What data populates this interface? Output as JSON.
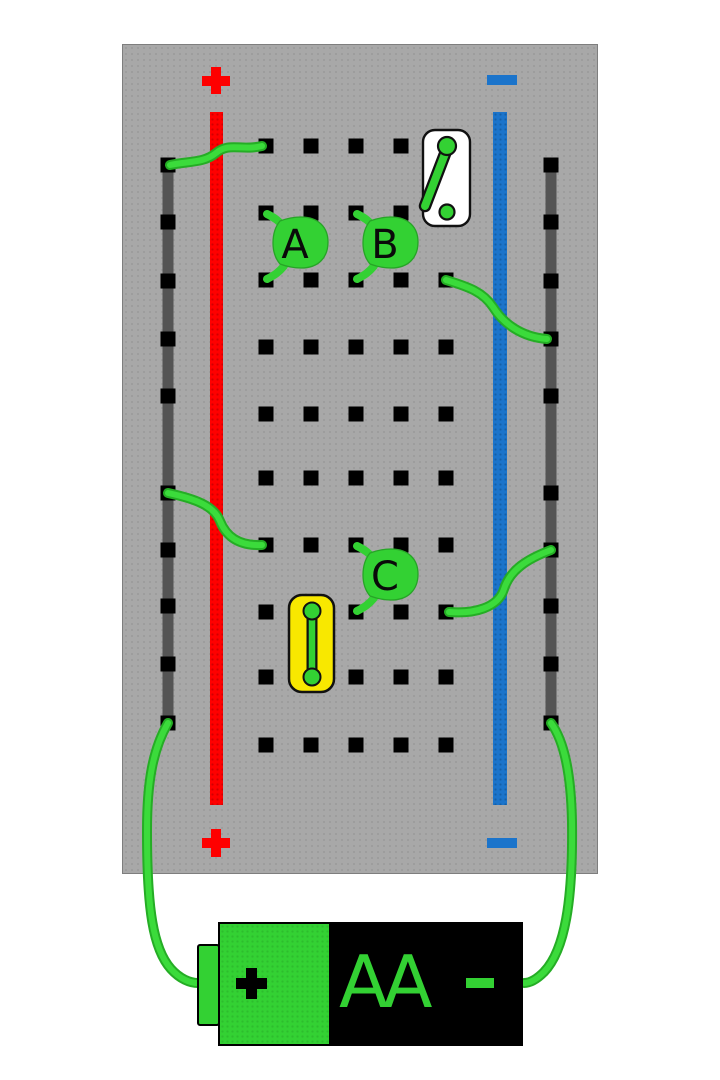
{
  "scene": {
    "width": 720,
    "height": 1080,
    "background": "#ffffff"
  },
  "board": {
    "x": 122,
    "y": 44,
    "width": 476,
    "height": 830,
    "color": "#a8a8a8"
  },
  "rails": {
    "positive": {
      "symbol": "+",
      "color": "#fe0000",
      "x": 210,
      "width": 13,
      "top": 112,
      "bottom": 805
    },
    "negative": {
      "symbol": "−",
      "color": "#1b74cb",
      "x": 493,
      "width": 14,
      "top": 112,
      "bottom": 805
    }
  },
  "rail_buses": {
    "left_x": 168,
    "right_x": 551,
    "top": 165,
    "bottom": 723,
    "wire_color": "#545454",
    "hole_ys": [
      165,
      222,
      281,
      339,
      396,
      493,
      550,
      606,
      664,
      723
    ]
  },
  "grid": {
    "column_xs": [
      266,
      311,
      356,
      401,
      446
    ],
    "row_ys": [
      146,
      213,
      280,
      347,
      414,
      478,
      545,
      612,
      677,
      745
    ],
    "hole_size": 15,
    "hole_color": "#000000",
    "hidden_holes": [
      [
        4,
        0
      ],
      [
        4,
        1
      ],
      [
        1,
        7
      ],
      [
        1,
        8
      ]
    ]
  },
  "wires": [
    {
      "name": "wire-row1-to-positive-rail",
      "path": "M262,146 C241,151 229,142 216,153 C204,163 189,161 170,165"
    },
    {
      "name": "wire-row3-to-negative-rail",
      "path": "M446,280 C469,287 483,292 493,307 C503,323 521,337 547,339"
    },
    {
      "name": "wire-positive-rail-to-row7",
      "path": "M168,493 C196,499 214,506 220,521 C226,536 238,546 262,545"
    },
    {
      "name": "wire-row8-to-negative-rail",
      "path": "M551,550 C527,559 510,570 504,589 C498,608 474,614 449,612"
    },
    {
      "name": "battery-positive-wire",
      "path": "M168,723 C153,749 147,781 147,831 C147,909 153,949 171,969 C180,979 190,983 198,983"
    },
    {
      "name": "battery-negative-wire",
      "path": "M551,723 C564,741 571,772 572,822 C573,901 565,950 544,972 C536,980 529,983 524,983"
    }
  ],
  "chips": [
    {
      "label": "A",
      "x": 266,
      "top": 213,
      "bottom": 280
    },
    {
      "label": "B",
      "x": 356,
      "top": 213,
      "bottom": 280
    },
    {
      "label": "C",
      "x": 356,
      "top": 545,
      "bottom": 612
    }
  ],
  "switch": {
    "x": 423,
    "y": 130,
    "width": 47,
    "height": 96,
    "state": "open",
    "contact_top": [
      447,
      146
    ],
    "contact_bottom": [
      447,
      212
    ],
    "lever_end": [
      425,
      206
    ]
  },
  "lamp": {
    "x": 289,
    "y": 595,
    "width": 45,
    "height": 97,
    "state": "closed",
    "contact_top": [
      312,
      611
    ],
    "contact_bottom": [
      312,
      677
    ]
  },
  "battery": {
    "plus_symbol": "+",
    "size_label": "AA",
    "minus_symbol": "−",
    "green_color": "#33d133",
    "black_color": "#000000"
  },
  "palette": {
    "green": "#33d133",
    "green_bright": "#3bdb3b",
    "green_dark": "#25ad25",
    "chip_stroke": "#27a427",
    "yellow": "#f8e800",
    "red": "#fe0000",
    "blue": "#1b74cb",
    "white": "#ffffff",
    "outline": "#111111"
  }
}
